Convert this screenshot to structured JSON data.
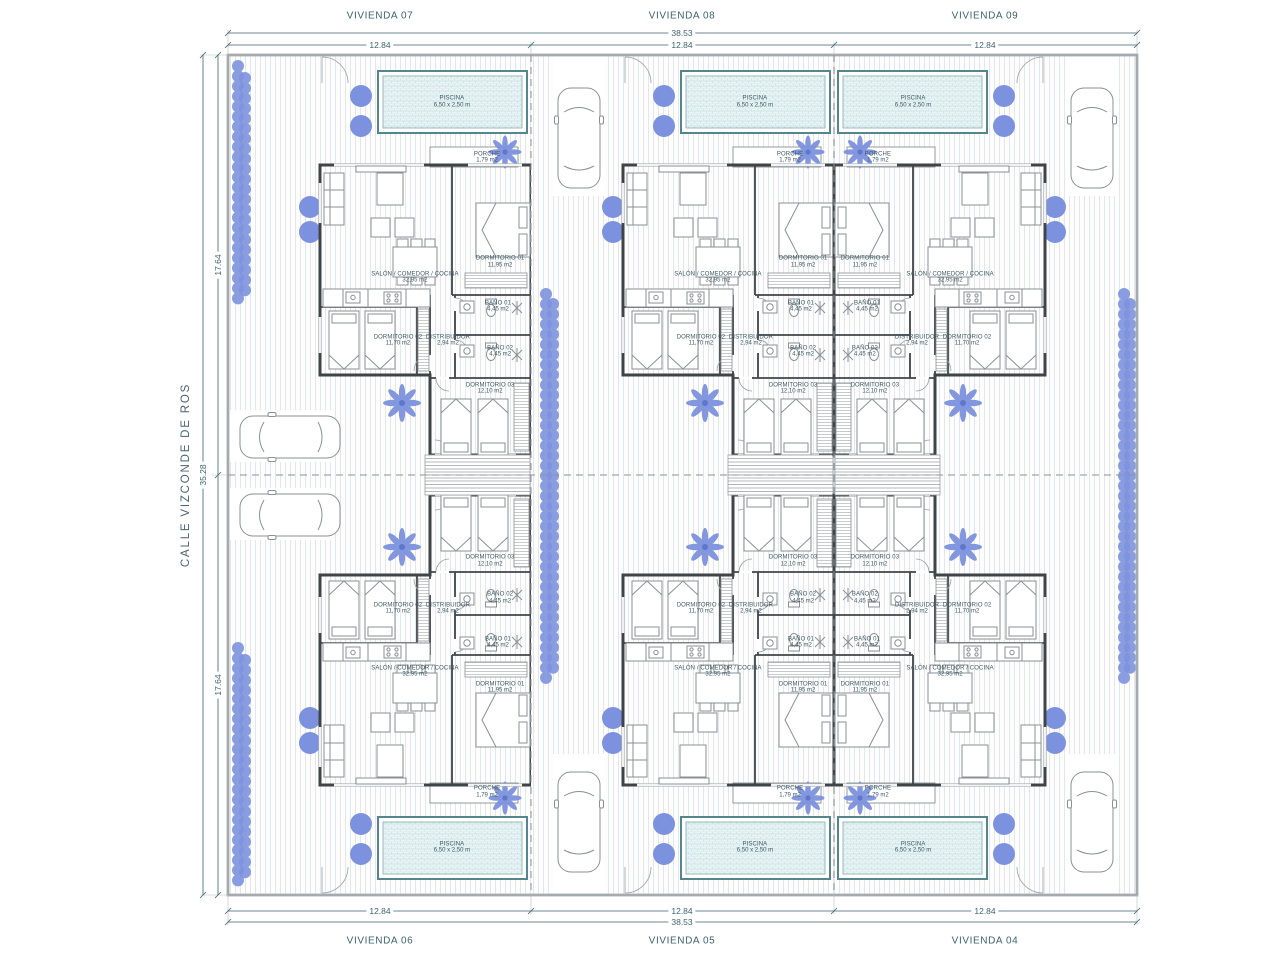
{
  "street": {
    "label": "CALLE VIZCONDE DE ROS"
  },
  "dimensions": {
    "overall_width": "38.53",
    "unit_width": "12.84",
    "overall_depth": "35.28",
    "half_depth": "17.64"
  },
  "units": [
    {
      "label": "VIVIENDA 07",
      "px": 228,
      "py": 55,
      "flip_x": false,
      "flip_y": false
    },
    {
      "label": "VIVIENDA 08",
      "px": 531,
      "py": 55,
      "flip_x": false,
      "flip_y": false
    },
    {
      "label": "VIVIENDA 09",
      "px": 834,
      "py": 55,
      "flip_x": true,
      "flip_y": false
    },
    {
      "label": "VIVIENDA 06",
      "px": 228,
      "py": 475,
      "flip_x": false,
      "flip_y": true
    },
    {
      "label": "VIVIENDA 05",
      "px": 531,
      "py": 475,
      "flip_x": false,
      "flip_y": true
    },
    {
      "label": "VIVIENDA 04",
      "px": 834,
      "py": 475,
      "flip_x": true,
      "flip_y": true
    }
  ],
  "rooms": [
    {
      "id": "piscina",
      "name": "PISCINA",
      "area": "6,50 x 2,50 m",
      "x": 0.739,
      "y": 0.112
    },
    {
      "id": "porche",
      "name": "PORCHE",
      "area": "1,79 m2",
      "x": 0.855,
      "y": 0.245
    },
    {
      "id": "salon-comedor-cocina",
      "name": "SALÓN / COMEDOR / COCINA",
      "area": "32,95 m2",
      "x": 0.617,
      "y": 0.531
    },
    {
      "id": "dormitorio-01",
      "name": "DORMITORIO 01",
      "area": "11,95 m2",
      "x": 0.898,
      "y": 0.493
    },
    {
      "id": "bano-01",
      "name": "BAÑO 01",
      "area": "4,45 m2",
      "x": 0.891,
      "y": 0.6
    },
    {
      "id": "dormitorio-02",
      "name": "DORMITORIO 02",
      "area": "11,70 m2",
      "x": 0.561,
      "y": 0.681
    },
    {
      "id": "distribuidor",
      "name": "DISTRIBUIDOR",
      "area": "2,94 m2",
      "x": 0.726,
      "y": 0.681
    },
    {
      "id": "bano-02",
      "name": "BAÑO 02",
      "area": "4,45 m2",
      "x": 0.898,
      "y": 0.707
    },
    {
      "id": "dormitorio-03",
      "name": "DORMITORIO 03",
      "area": "12,10 m2",
      "x": 0.865,
      "y": 0.795
    }
  ],
  "colors": {
    "line": "#8d9499",
    "wall": "#3f4447",
    "dim_text": "#3c6370",
    "vegetation_blue": "#7d92de",
    "pool_edge": "#55858d",
    "pool_fill": "#ecf5f5"
  }
}
